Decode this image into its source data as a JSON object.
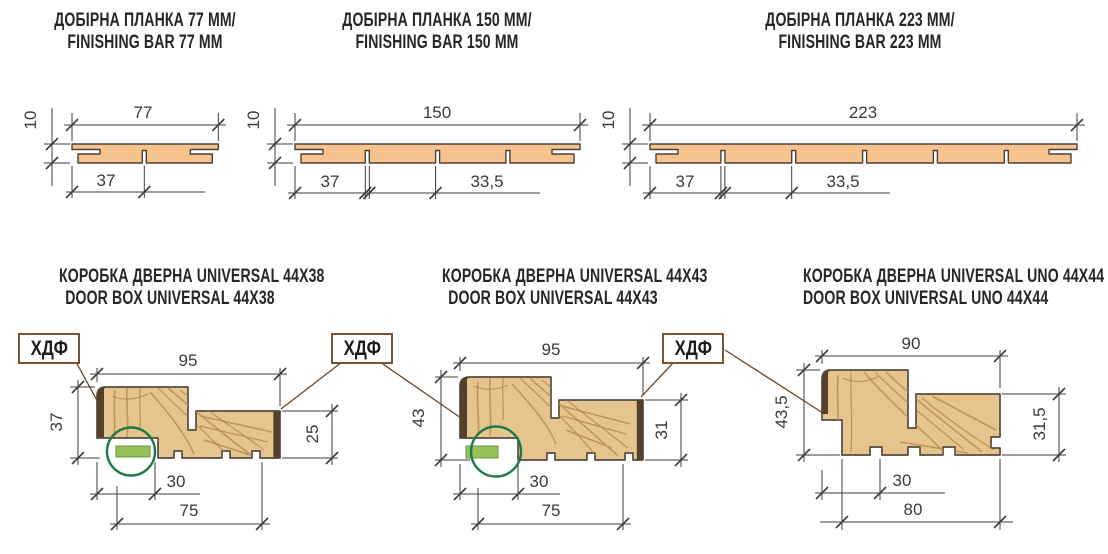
{
  "hdf_label": "ХДФ",
  "top_panels": [
    {
      "title_line1": "ДОБІРНА ПЛАНКА 77 ММ/",
      "title_line2": "FINISHING BAR 77 MM",
      "width": "77",
      "thickness": "10",
      "offset": "37"
    },
    {
      "title_line1": "ДОБІРНА ПЛАНКА 150 ММ/",
      "title_line2": "FINISHING BAR 150 MM",
      "width": "150",
      "thickness": "10",
      "offset": "37",
      "pitch": "33,5"
    },
    {
      "title_line1": "ДОБІРНА ПЛАНКА 223 ММ/",
      "title_line2": "FINISHING BAR 223 MM",
      "width": "223",
      "thickness": "10",
      "offset": "37",
      "pitch": "33,5"
    }
  ],
  "bottom_panels": [
    {
      "title_line1": "КОРОБКА ДВЕРНА UNIVERSAL 44X38",
      "title_line2": "DOOR BOX UNIVERSAL 44X38",
      "width": "95",
      "height": "37",
      "stop_height": "25",
      "seal_offset": "30",
      "base_width": "75"
    },
    {
      "title_line1": "КОРОБКА ДВЕРНА UNIVERSAL 44X43",
      "title_line2": "DOOR BOX UNIVERSAL 44X43",
      "width": "95",
      "height": "43",
      "stop_height": "31",
      "seal_offset": "30",
      "base_width": "75"
    },
    {
      "title_line1": "КОРОБКА ДВЕРНА UNIVERSAL UNO 44X44",
      "title_line2": "DOOR BOX UNIVERSAL UNO 44X44",
      "width": "90",
      "height": "43,5",
      "stop_height": "31,5",
      "seal_offset": "30",
      "base_width": "80"
    }
  ],
  "colors": {
    "bar_fill": "#f6c28e",
    "wood_fill": "#e5c58d",
    "hdf_cap": "#54402b",
    "seal_green": "#97c25b",
    "circle_green": "#1d7947",
    "leader_brown": "#6e4526",
    "line": "#3c3c3c"
  }
}
